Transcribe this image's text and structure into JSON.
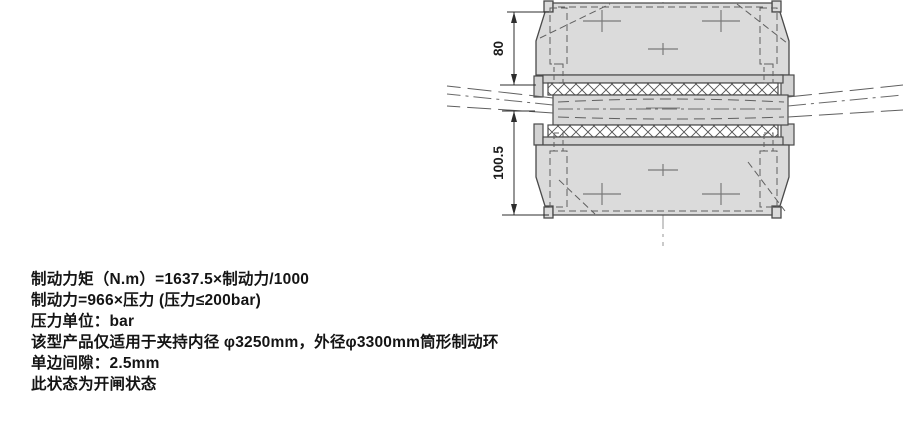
{
  "colors": {
    "background": "#ffffff",
    "body_fill": "#dbdbdb",
    "plate_fill": "#d3d3d3",
    "ring_fill": "#d8d8d8",
    "outline": "#4a4a4a",
    "dimension_line": "#2d2d2d",
    "text": "#141414"
  },
  "drawing": {
    "description": "Cross-section of disc brake caliper clamping a brake ring, open state",
    "dimensions": [
      {
        "label": "80"
      },
      {
        "label": "100.5"
      }
    ]
  },
  "notes": [
    "制动力矩（N.m）=1637.5×制动力/1000",
    "制动力=966×压力 (压力≤200bar)",
    "压力单位：bar",
    "该型产品仅适用于夹持内径 φ3250mm，外径φ3300mm筒形制动环",
    "单边间隙：2.5mm",
    "此状态为开闸状态"
  ]
}
